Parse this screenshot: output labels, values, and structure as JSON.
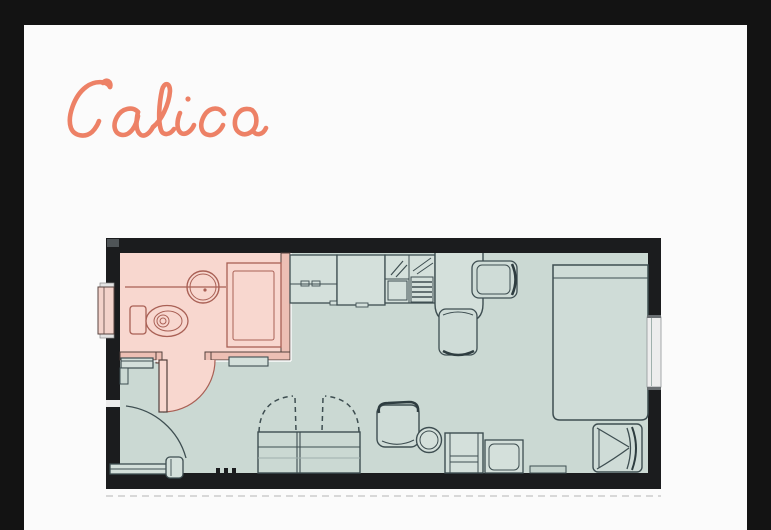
{
  "title": "Calico",
  "colors": {
    "background": "#131313",
    "card": "#fbfbfb",
    "title_script": "#ed8166",
    "walls": "#1b1c1e",
    "floor": "#cbd9d3",
    "bathroom_fill": "#f8d7cf",
    "bathroom_wall_fill": "#edbfb4",
    "bathroom_line": "#a96055",
    "furniture_fill": "#d4e0db",
    "furniture_line": "#3e4e51",
    "window_fill": "#ededed"
  },
  "floorplan": {
    "type": "studio-apartment-plan",
    "rooms": [
      {
        "name": "bathroom",
        "fixtures": [
          "toilet",
          "vanity-sink",
          "shower",
          "inward-swing-door"
        ]
      },
      {
        "name": "living-area",
        "fixtures": [
          "kitchen-cabinet",
          "kitchen-counter",
          "kitchen-sink-with-drainer",
          "breakfast-peninsula",
          "dining-chair",
          "dining-chair",
          "bed",
          "wardrobe-with-hinged-doors",
          "lounge-chair",
          "round-side-table",
          "desk-unit",
          "stool",
          "armchair",
          "entrance-door",
          "wall-shelf"
        ]
      }
    ],
    "windows": [
      "left-wall-window",
      "right-wall-window"
    ]
  }
}
